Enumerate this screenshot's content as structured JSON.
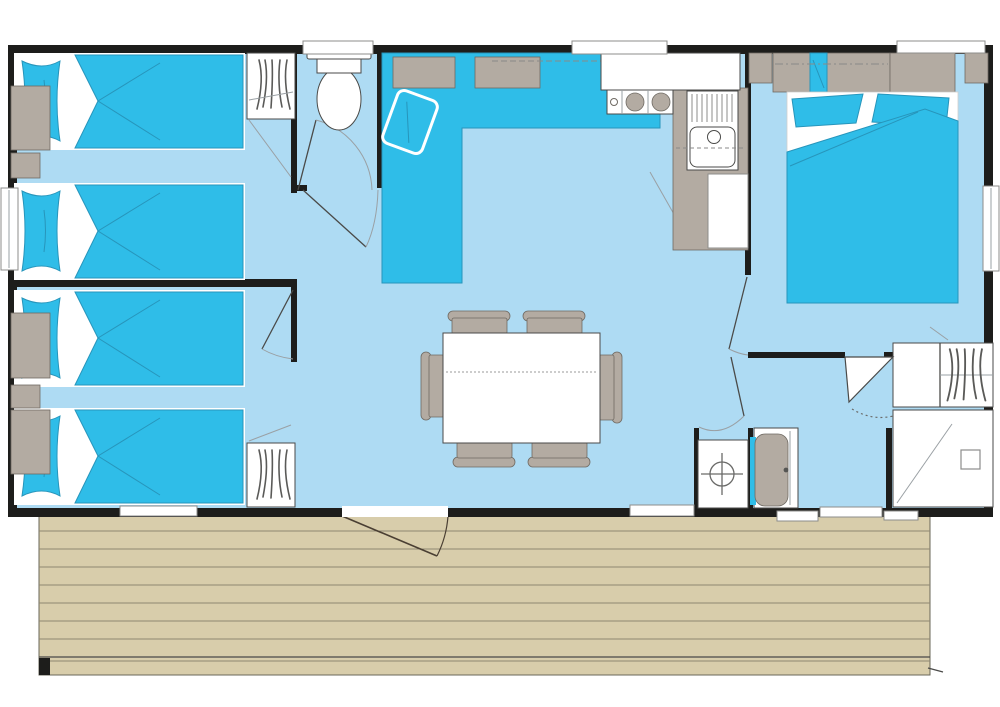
{
  "plan": {
    "type": "mobile-home-floor-plan",
    "canvas": {
      "width": 1000,
      "height": 707
    }
  },
  "colors": {
    "background": "#ffffff",
    "wall": "#1d1d1b",
    "floor": "#aedbf3",
    "furniture_blue": "#2fbde8",
    "blue_outline": "#2795bb",
    "furniture_gray": "#b3aba2",
    "deck": "#d8cdab",
    "deck_line": "#8e8671"
  },
  "rooms": [
    {
      "id": "bedroom-twin-1",
      "position": "top-left",
      "furniture": [
        "single-bed",
        "single-bed",
        "nightstand",
        "nightstand",
        "wardrobe-hanging"
      ]
    },
    {
      "id": "bedroom-twin-2",
      "position": "bottom-left",
      "furniture": [
        "single-bed",
        "single-bed",
        "nightstand",
        "nightstand",
        "nightstand",
        "wardrobe-hanging"
      ]
    },
    {
      "id": "wc",
      "position": "top-center",
      "furniture": [
        "toilet"
      ]
    },
    {
      "id": "living-dining",
      "position": "center",
      "furniture": [
        "corner-sofa",
        "sofa-shelf",
        "sofa-shelf",
        "throw-cushion",
        "dining-table",
        "chair",
        "chair",
        "chair",
        "chair",
        "chair",
        "chair"
      ]
    },
    {
      "id": "kitchen",
      "position": "top-center-right",
      "furniture": [
        "worktop",
        "hob-3-burners",
        "sink-with-drainer",
        "base-cabinet",
        "counter"
      ]
    },
    {
      "id": "master-bedroom",
      "position": "right",
      "furniture": [
        "double-bed",
        "pillow",
        "pillow",
        "overhead-cabinets",
        "corner-cabinet",
        "corner-cabinet"
      ]
    },
    {
      "id": "bathroom",
      "position": "bottom-right",
      "furniture": [
        "wardrobe-hanging",
        "shower",
        "washbasin-crosshair",
        "water-heater"
      ]
    }
  ],
  "openings": {
    "windows_top": 3,
    "windows_left": 1,
    "windows_right": 1,
    "windows_bottom": 4,
    "entrance_doors": 1,
    "interior_door_swings": 6
  },
  "deck": {
    "plank_rows": 9,
    "has_door_swing": true,
    "step_marks": 2
  },
  "counts": {
    "single_beds": 4,
    "double_beds": 1,
    "chairs": 6,
    "wardrobes": 3,
    "toilets": 1,
    "showers": 1,
    "hob_burners": 3
  }
}
